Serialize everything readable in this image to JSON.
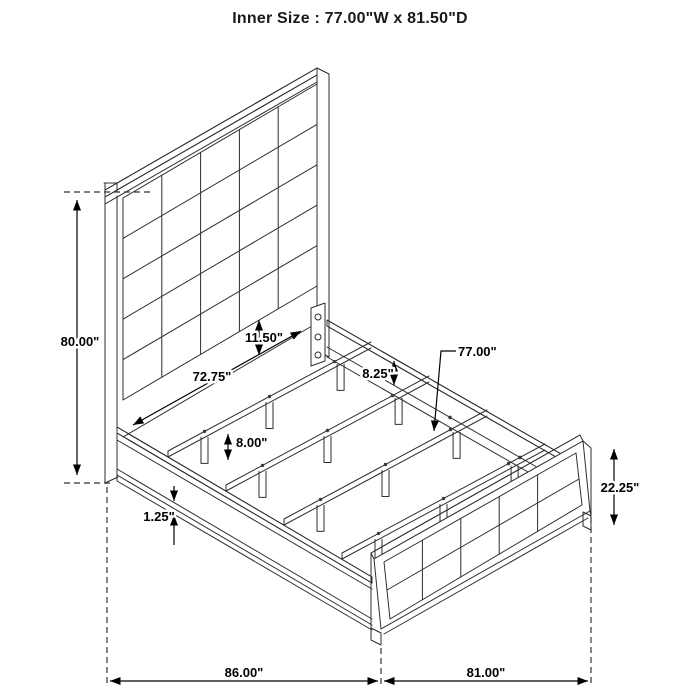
{
  "title": "Inner Size : 77.00\"W x 81.50\"D",
  "dimensions": {
    "headboard_height": "80.00\"",
    "rail_face_height": "11.50\"",
    "inner_rail_length": "72.75\"",
    "rail_top_to_slat": "8.25\"",
    "slat_length": "77.00\"",
    "slat_leg_height": "8.00\"",
    "rail_ledge": "1.25\"",
    "footboard_height": "22.25\"",
    "overall_depth": "86.00\"",
    "overall_width": "81.00\""
  }
}
